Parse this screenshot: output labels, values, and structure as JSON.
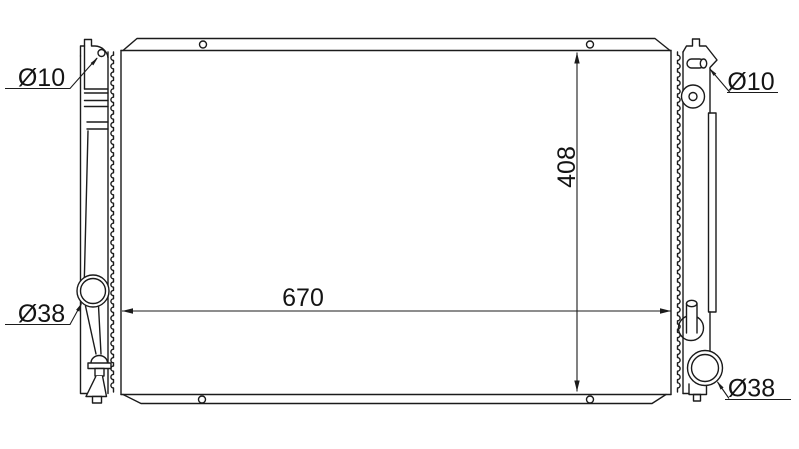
{
  "drawing": {
    "dim_width_label": "670",
    "dim_height_label": "408",
    "port_top_left_label": "Ø10",
    "port_top_right_label": "Ø10",
    "port_bottom_left_label": "Ø38",
    "port_bottom_right_label": "Ø38"
  },
  "colors": {
    "line": "#1b1b1b",
    "background": "#ffffff"
  }
}
